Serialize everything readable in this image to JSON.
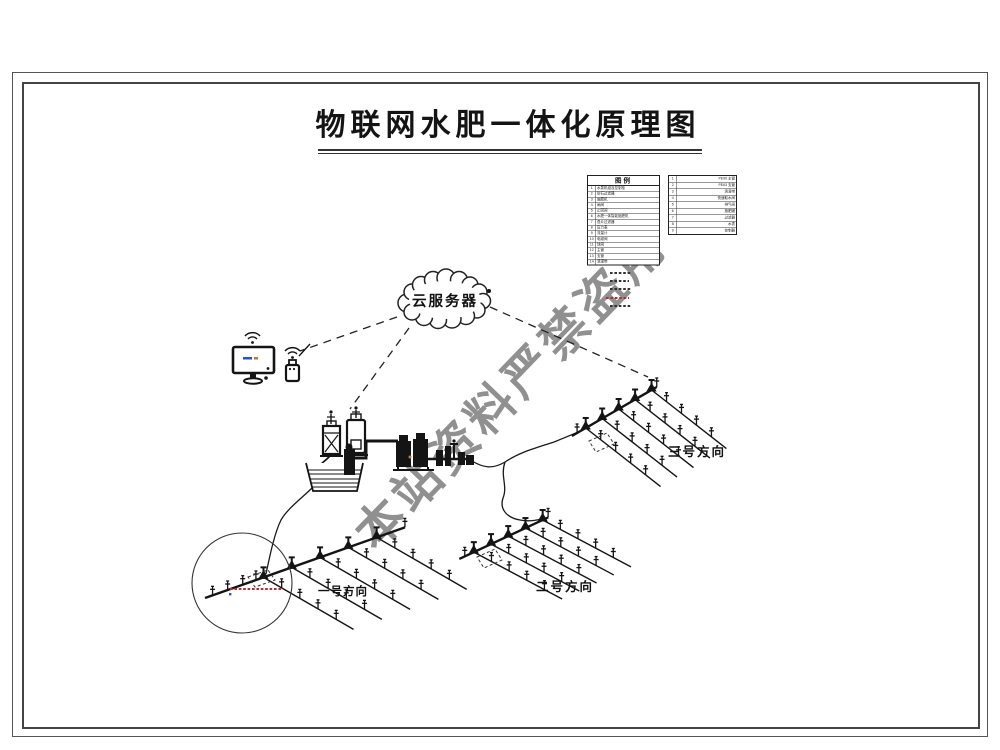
{
  "page": {
    "title": "物联网水肥一体化原理图"
  },
  "cloud": {
    "label": "云服务器"
  },
  "watermark": {
    "text": "本站资料严禁盗用"
  },
  "fields": [
    {
      "label": "一号方向"
    },
    {
      "label": "二号方向"
    },
    {
      "label": "三号方向"
    }
  ],
  "legend": {
    "table1": {
      "header": "图例",
      "rows": [
        {
          "n": "1",
          "t": "水泵机组及控制柜"
        },
        {
          "n": "2",
          "t": "砂石过滤器"
        },
        {
          "n": "3",
          "t": "施肥机"
        },
        {
          "n": "4",
          "t": "闸阀"
        },
        {
          "n": "5",
          "t": "止回阀"
        },
        {
          "n": "6",
          "t": "水肥一体智能施肥机"
        },
        {
          "n": "7",
          "t": "叠片过滤器"
        },
        {
          "n": "8",
          "t": "压力表"
        },
        {
          "n": "9",
          "t": "流量计"
        },
        {
          "n": "10",
          "t": "电磁阀"
        },
        {
          "n": "11",
          "t": "球阀"
        },
        {
          "n": "12",
          "t": "主管"
        },
        {
          "n": "13",
          "t": "支管"
        },
        {
          "n": "14",
          "t": "滴灌带"
        }
      ]
    },
    "table2": {
      "rows": [
        {
          "n": "1",
          "t": "PE90 主管"
        },
        {
          "n": "2",
          "t": "PE63 支管"
        },
        {
          "n": "3",
          "t": "滴灌带"
        },
        {
          "n": "4",
          "t": "快速取水阀"
        },
        {
          "n": "5",
          "t": "排气阀"
        },
        {
          "n": "6",
          "t": "施肥罐"
        },
        {
          "n": "7",
          "t": "过滤器"
        },
        {
          "n": "8",
          "t": "水表"
        },
        {
          "n": "9",
          "t": "控制器"
        }
      ]
    }
  },
  "colors": {
    "line": "#141414",
    "watermark": "#7d7d7d",
    "accent_blue": "#2b52c8",
    "accent_orange": "#c87530",
    "accent_red": "#b03030"
  }
}
